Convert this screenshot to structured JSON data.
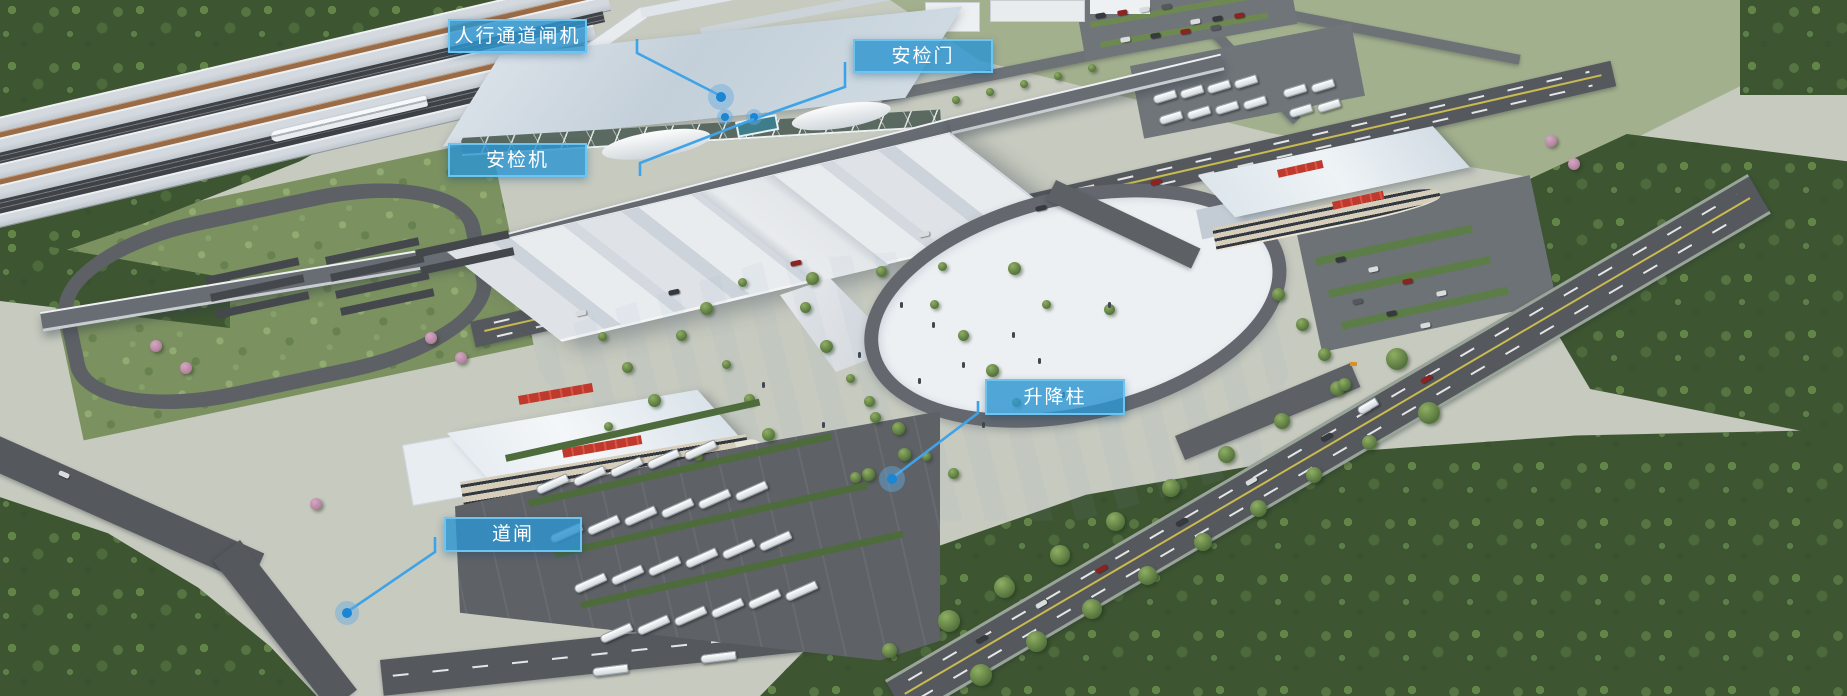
{
  "colors": {
    "label_fill": "#2D95D0",
    "label_border": "#6CC4EF",
    "label_text": "#FFFFFF",
    "leader_line": "#3FA3E8",
    "marker_dot": "#1B86D3",
    "marker_halo": "rgba(100,170,225,0.45)"
  },
  "annotations": [
    {
      "id": "pedestrian-channel-gate",
      "label": "人行通道闸机",
      "box": {
        "x": 448,
        "y": 19,
        "w": 139,
        "h": 34
      },
      "leader": [
        [
          637,
          39
        ],
        [
          637,
          53
        ],
        [
          721,
          96
        ]
      ],
      "markers": [
        {
          "x": 721,
          "y": 97,
          "r": 5,
          "halo": 13
        }
      ]
    },
    {
      "id": "security-door",
      "label": "安检门",
      "box": {
        "x": 853,
        "y": 39,
        "w": 140,
        "h": 34
      },
      "leader": [
        [
          845,
          62
        ],
        [
          845,
          87
        ],
        [
          754,
          119
        ]
      ],
      "markers": [
        {
          "x": 725,
          "y": 117,
          "r": 4,
          "halo": 8
        },
        {
          "x": 754,
          "y": 117,
          "r": 4,
          "halo": 8
        }
      ]
    },
    {
      "id": "security-scanner",
      "label": "安检机",
      "box": {
        "x": 448,
        "y": 143,
        "w": 139,
        "h": 34
      },
      "leader": [
        [
          754,
          119
        ],
        [
          640,
          163
        ],
        [
          640,
          176
        ]
      ],
      "markers": []
    },
    {
      "id": "lifting-bollard",
      "label": "升降柱",
      "box": {
        "x": 985,
        "y": 379,
        "w": 140,
        "h": 36
      },
      "leader": [
        [
          978,
          401
        ],
        [
          978,
          413
        ],
        [
          892,
          478
        ]
      ],
      "markers": [
        {
          "x": 892,
          "y": 479,
          "r": 5,
          "halo": 13
        }
      ]
    },
    {
      "id": "barrier-gate",
      "label": "道闸",
      "box": {
        "x": 444,
        "y": 517,
        "w": 138,
        "h": 35
      },
      "leader": [
        [
          435,
          537
        ],
        [
          435,
          552
        ],
        [
          347,
          612
        ]
      ],
      "markers": [
        {
          "x": 347,
          "y": 613,
          "r": 5,
          "halo": 12
        }
      ]
    }
  ]
}
